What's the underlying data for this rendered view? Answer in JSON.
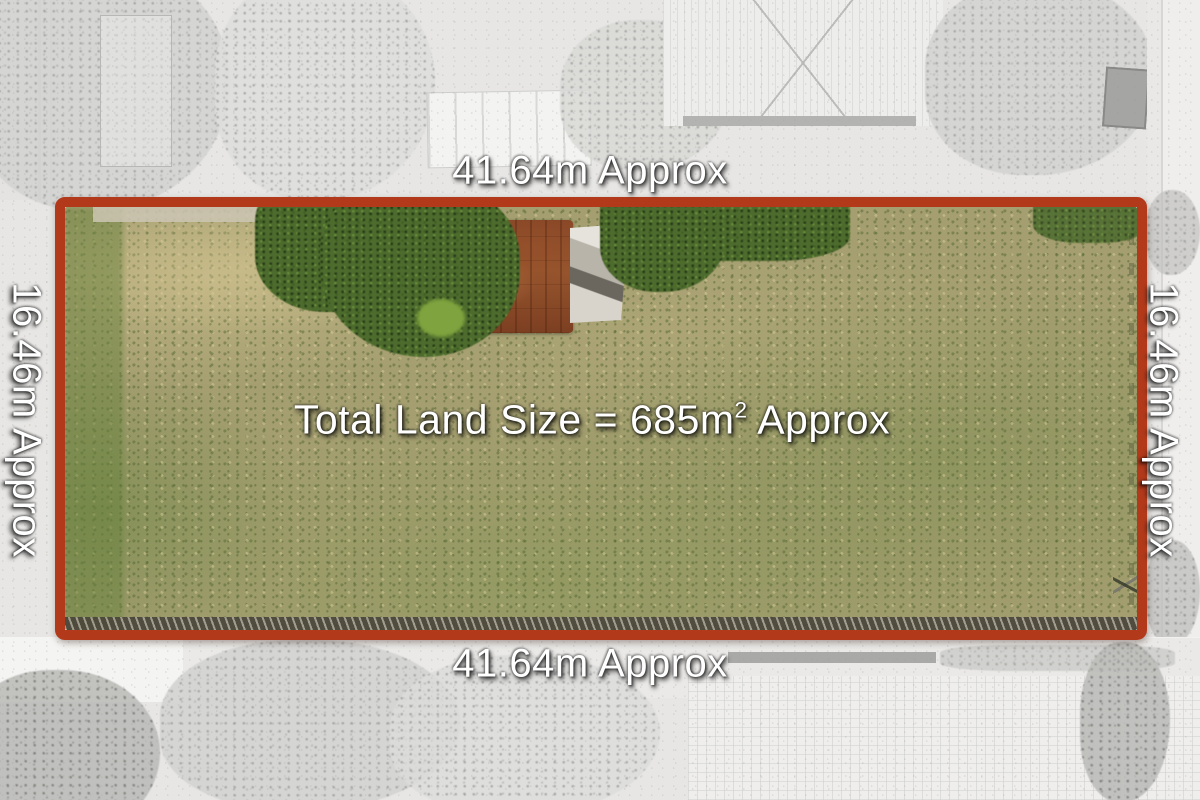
{
  "boundary": {
    "top_label": "41.64m Approx",
    "bottom_label": "41.64m Approx",
    "left_label": "16.46m Approx",
    "right_label": "16.46m Approx"
  },
  "area_label": {
    "prefix": "Total Land Size = 685m",
    "superscript": "2",
    "suffix": " Approx"
  },
  "measurements": {
    "frontage_m": "41.64",
    "depth_m": "16.46",
    "total_area_sqm": "685"
  },
  "colors": {
    "boundary_outline": "#b23a1b",
    "label_text": "#ffffff",
    "grass_base": "#a49e70",
    "hedge_green": "#4c6b2d",
    "shed_rust": "#8f4c28",
    "surroundings_gray": "#e7e6e4"
  }
}
